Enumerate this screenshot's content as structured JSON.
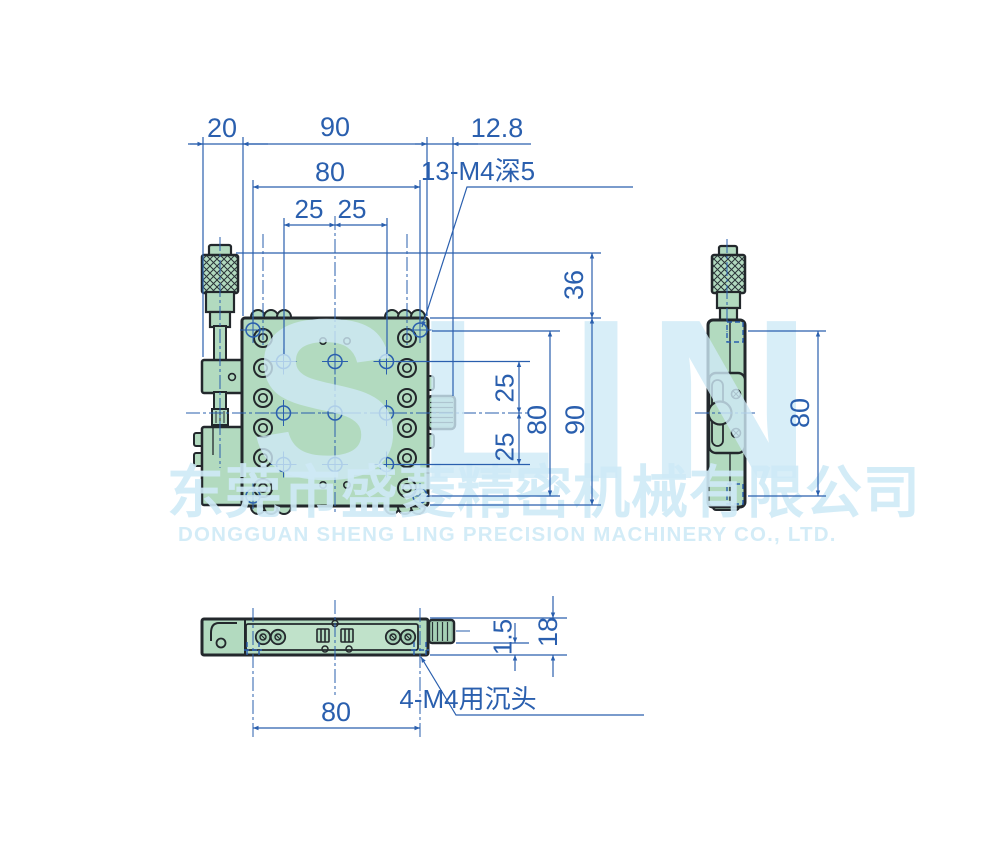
{
  "watermark": {
    "logo": "SLIN",
    "company_cn": "东莞市盛菱精密机械有限公司",
    "company_en": "DONGGUAN SHENG LING PRECISION MACHINERY CO., LTD."
  },
  "front_view": {
    "dim_micrometer_offset": "20",
    "dim_overall_width": "90",
    "dim_knob_protrusion": "12.8",
    "dim_mount_hole_span_h": "80",
    "dim_hole_pitch_h_left": "25",
    "dim_hole_pitch_h_right": "25",
    "label_thread_holes": "13-M4深5",
    "dim_micrometer_height": "36",
    "dim_hole_pitch_v_top": "25",
    "dim_hole_pitch_v_bottom": "25",
    "dim_mount_hole_span_v": "80",
    "dim_overall_height": "90"
  },
  "side_view": {
    "dim_mount_hole_span": "80"
  },
  "bottom_view": {
    "dim_plate_step": "1.5",
    "dim_base_thickness": "18",
    "dim_counterbore_span": "80",
    "label_counterbore_holes": "4-M4用沉头"
  },
  "colors": {
    "dimension_blue": "#2a5fae",
    "body_green": "#b2dabf",
    "panel_green": "#c0e2ca",
    "knob_green": "#a5d0b5",
    "outline_dark": "#23282c",
    "watermark_blue": "#cfeaf7"
  }
}
